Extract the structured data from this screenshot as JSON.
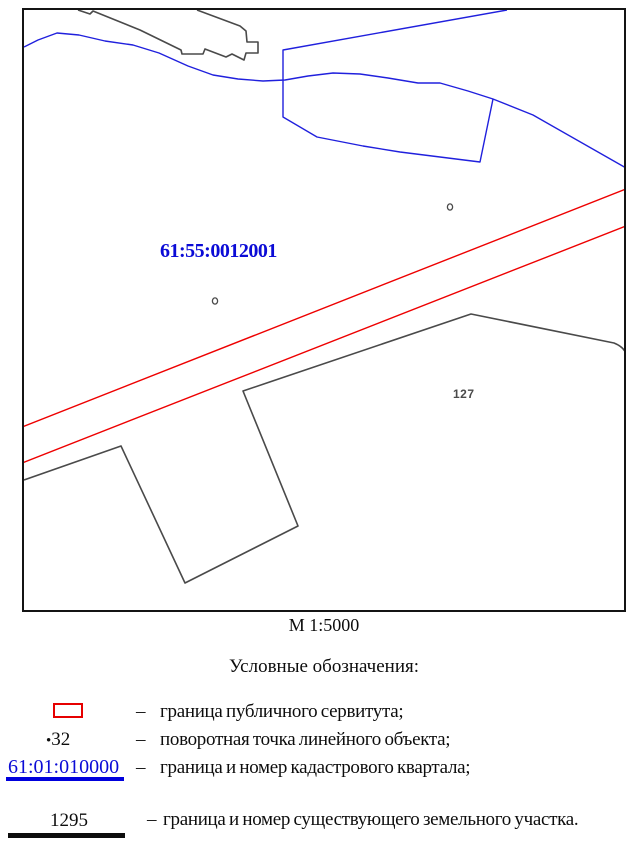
{
  "map": {
    "quarter_label": "61:55:0012001",
    "parcel_label": "127",
    "scale_label": "М 1:5000"
  },
  "legend": {
    "title": "Условные обозначения:",
    "dash": "–",
    "items": [
      {
        "id": "servitude",
        "symbol_text": "",
        "label": "граница публичного сервитута;"
      },
      {
        "id": "turning-point",
        "bullet": "•",
        "symbol_text": "32",
        "label": "поворотная точка линейного объекта;"
      },
      {
        "id": "cadastral-quarter",
        "symbol_text": "61:01:010000",
        "label": "граница и номер кадастрового квартала;"
      },
      {
        "id": "existing-parcel",
        "symbol_text": "1295",
        "label": "граница и номер существующего земельного участка."
      }
    ]
  },
  "colors": {
    "servitude_red": "#ee0000",
    "cadastral_blue": "#2020dd",
    "parcel_gray": "#555555",
    "label_blue": "#0b0bd6",
    "text_black": "#0d0d0d"
  }
}
